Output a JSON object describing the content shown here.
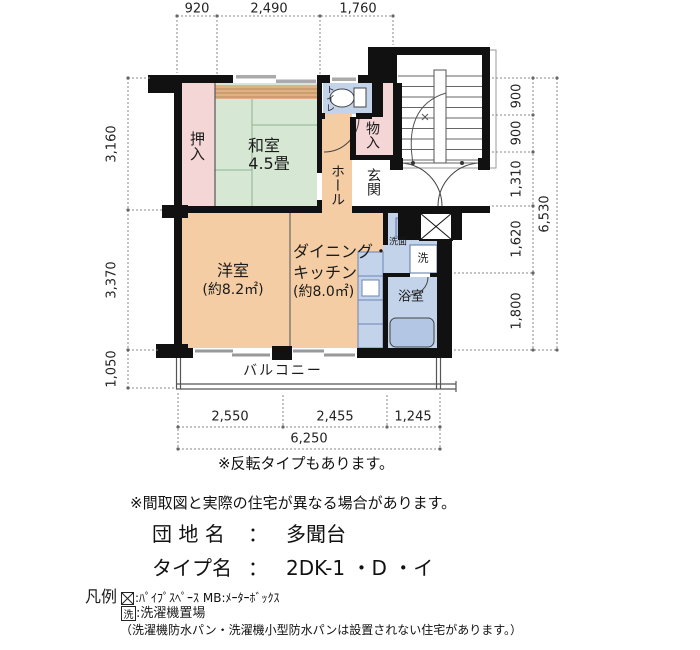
{
  "plan": {
    "rooms": {
      "oshiire": "押入",
      "washitsu": "和室",
      "washitsu_size": "4.5畳",
      "toilet": "トイレ",
      "storage": "物入",
      "hall": "ホール",
      "entrance": "玄関",
      "western_room": "洋室",
      "western_room_size": "(約8.2㎡)",
      "dk_line1": "ダイニング・",
      "dk_line2": "キッチン",
      "dk_line3": "(約8.0㎡)",
      "washstand": "洗面",
      "laundry": "洗",
      "bathroom": "浴室",
      "balcony": "バルコニー"
    },
    "dimensions": {
      "top": [
        "920",
        "2,490",
        "1,760"
      ],
      "left": [
        "3,160",
        "3,370",
        "1,050"
      ],
      "right": [
        "900",
        "900",
        "1,310",
        "1,620",
        "1,800"
      ],
      "right_total": "6,530",
      "bottom": [
        "2,550",
        "2,455",
        "1,245"
      ],
      "bottom_total": "6,250"
    }
  },
  "notes": {
    "reverse": "※反転タイプもあります。",
    "disclaimer": "※間取図と実際の住宅が異なる場合があります。"
  },
  "estate": {
    "name_label": "団 地 名",
    "name_sep": "：",
    "name_value": "多聞台",
    "type_label": "タイプ名",
    "type_sep": "：",
    "type_value": "2DK-1 ・D ・イ"
  },
  "legend": {
    "title": "凡例",
    "pipe_space": ":ﾊﾟｲﾌﾟｽﾍﾟｰｽ MB:ﾒｰﾀｰﾎﾞｯｸｽ",
    "laundry_symbol": "洗",
    "laundry": ":洗濯機置場",
    "note": "（洗濯機防水パン・洗濯機小型防水パンは設置されない住宅があります。）"
  },
  "colors": {
    "wall": "#111111",
    "closet_pink": "#f4d6d6",
    "tatami_green": "#d6e8d4",
    "room_orange": "#f4cda4",
    "wet_blue": "#c3d3ea",
    "tatami_edge": "#dfb184"
  }
}
